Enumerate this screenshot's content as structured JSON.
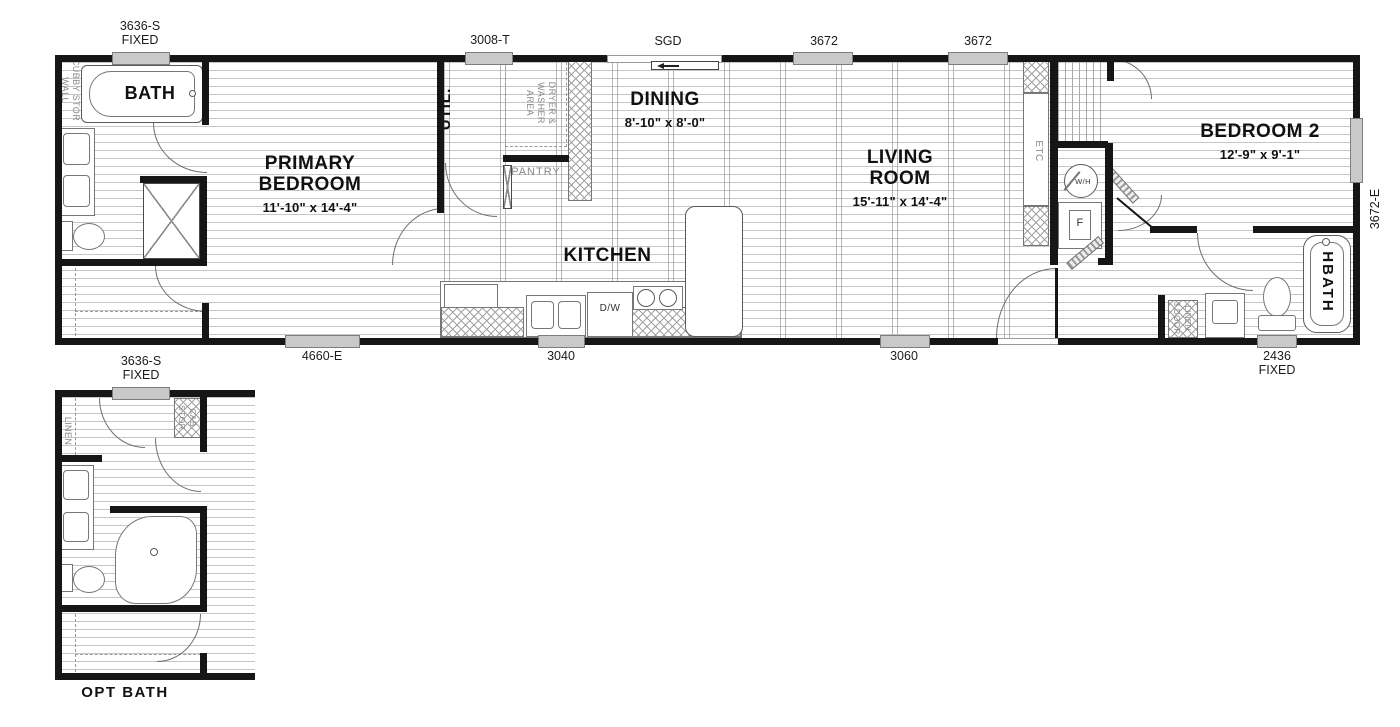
{
  "colors": {
    "wall": "#161616",
    "floor_line": "#c6c6c6",
    "window_fill": "#c9c9c9",
    "gray_text": "#8a8a8a"
  },
  "main_plan": {
    "rooms": {
      "bath": {
        "label": "BATH"
      },
      "primary_bedroom": {
        "line1": "PRIMARY",
        "line2": "BEDROOM",
        "dims": "11'-10\" x  14'-4\""
      },
      "util": {
        "label": "UTIL."
      },
      "dining": {
        "label": "DINING",
        "dims": "8'-10\" x  8'-0\""
      },
      "kitchen": {
        "label": "KITCHEN"
      },
      "living_room": {
        "line1": "LIVING",
        "line2": "ROOM",
        "dims": "15'-11\" x  14'-4\""
      },
      "bedroom2": {
        "label": "BEDROOM 2",
        "dims": "12'-9\" x  9'-1\""
      },
      "hbath": {
        "label": "HBATH"
      },
      "pantry": {
        "label": "PANTRY"
      }
    },
    "windows": {
      "top1": {
        "line1": "3636-S",
        "line2": "FIXED"
      },
      "top2": "3008-T",
      "sgd": "SGD",
      "top3": "3672",
      "top4": "3672",
      "right": "3672-E",
      "bottom1": "4660-E",
      "bottom2": "3040",
      "bottom3": "3060",
      "bottom4": {
        "line1": "2436",
        "line2": "FIXED"
      }
    },
    "annotations": {
      "wall_cubby": {
        "line1": "WALL",
        "line2": "CUBBY STOR"
      },
      "dryer_washer": {
        "line1": "DRYER & WASHER",
        "line2": "AREA"
      },
      "etc": "ETC",
      "water_heater": "W/H",
      "furnace": "F",
      "dishwasher": "D/W",
      "linen3": {
        "line1": "3 DOOR",
        "line2": "LINEN"
      }
    }
  },
  "opt_plan": {
    "title": "OPT BATH",
    "window": {
      "line1": "3636-S",
      "line2": "FIXED"
    },
    "annotations": {
      "linen": "LINEN",
      "stor_cab": {
        "line1": "STOR.",
        "line2": "CAB."
      }
    }
  }
}
